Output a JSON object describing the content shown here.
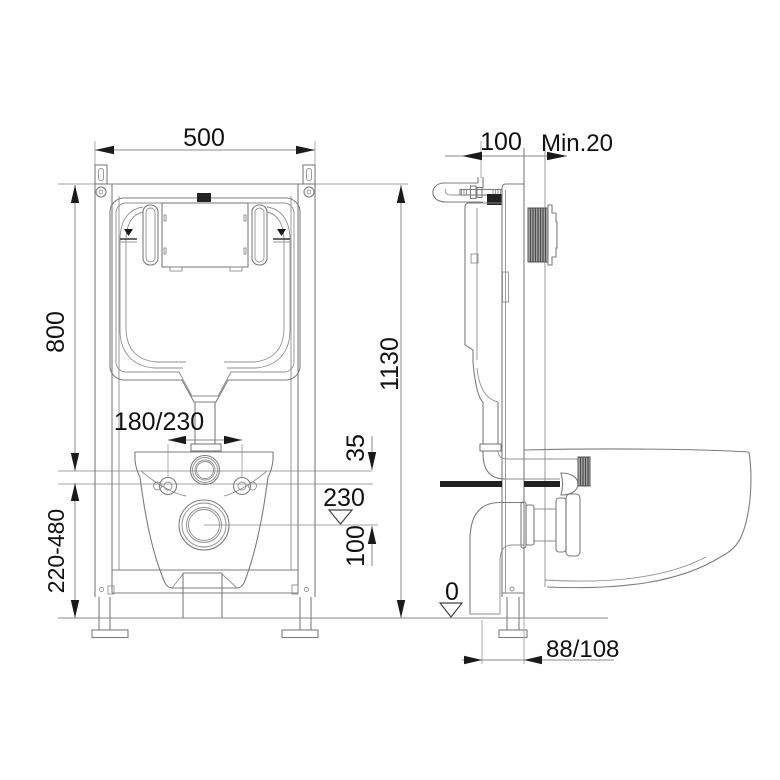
{
  "front_view": {
    "width": "500",
    "frame_height": "800",
    "overall_height": "1130",
    "leg_range": "220-480",
    "bolt_spacing": "180/230",
    "flush_offset": "35",
    "outlet_height": "230",
    "outlet_drop": "100"
  },
  "side_view": {
    "depth": "100",
    "wall_min": "Min.20",
    "floor_level": "0",
    "outlet_offset": "88/108"
  }
}
